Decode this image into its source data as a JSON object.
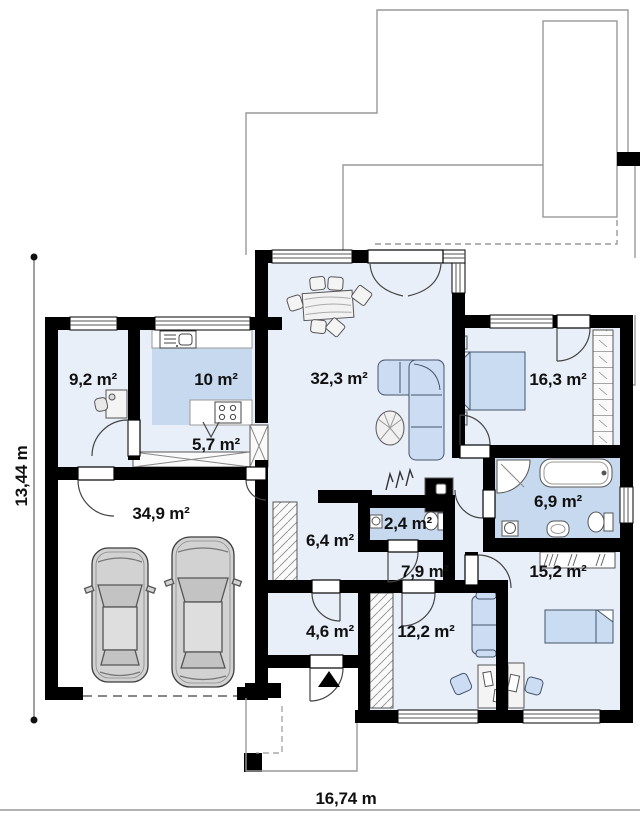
{
  "floor_plan": {
    "rooms": [
      {
        "name": "room-9-2",
        "area_label": "9,2 m²"
      },
      {
        "name": "kitchen",
        "area_label": "10 m²"
      },
      {
        "name": "living-room",
        "area_label": "32,3 m²"
      },
      {
        "name": "bedroom-right",
        "area_label": "16,3 m²"
      },
      {
        "name": "hall-5-7",
        "area_label": "5,7 m²"
      },
      {
        "name": "garage",
        "area_label": "34,9 m²"
      },
      {
        "name": "hall-6-4",
        "area_label": "6,4 m²"
      },
      {
        "name": "wc",
        "area_label": "2,4 m²"
      },
      {
        "name": "corridor-7-9",
        "area_label": "7,9 m²"
      },
      {
        "name": "bathroom",
        "area_label": "6,9 m²"
      },
      {
        "name": "bedroom-bottom",
        "area_label": "15,2 m²"
      },
      {
        "name": "vestibule",
        "area_label": "4,6 m²"
      },
      {
        "name": "office",
        "area_label": "12,2 m²"
      }
    ],
    "dimensions": {
      "left": "13,44 m",
      "bottom": "16,74 m"
    },
    "colors": {
      "wall": "#000000",
      "floor": "#e9eff9",
      "wet_zone": "#c7d9ee",
      "furniture_blue": "#ccdcf2",
      "outline_gray": "#999999",
      "car_body": "#d2d2d2"
    }
  }
}
